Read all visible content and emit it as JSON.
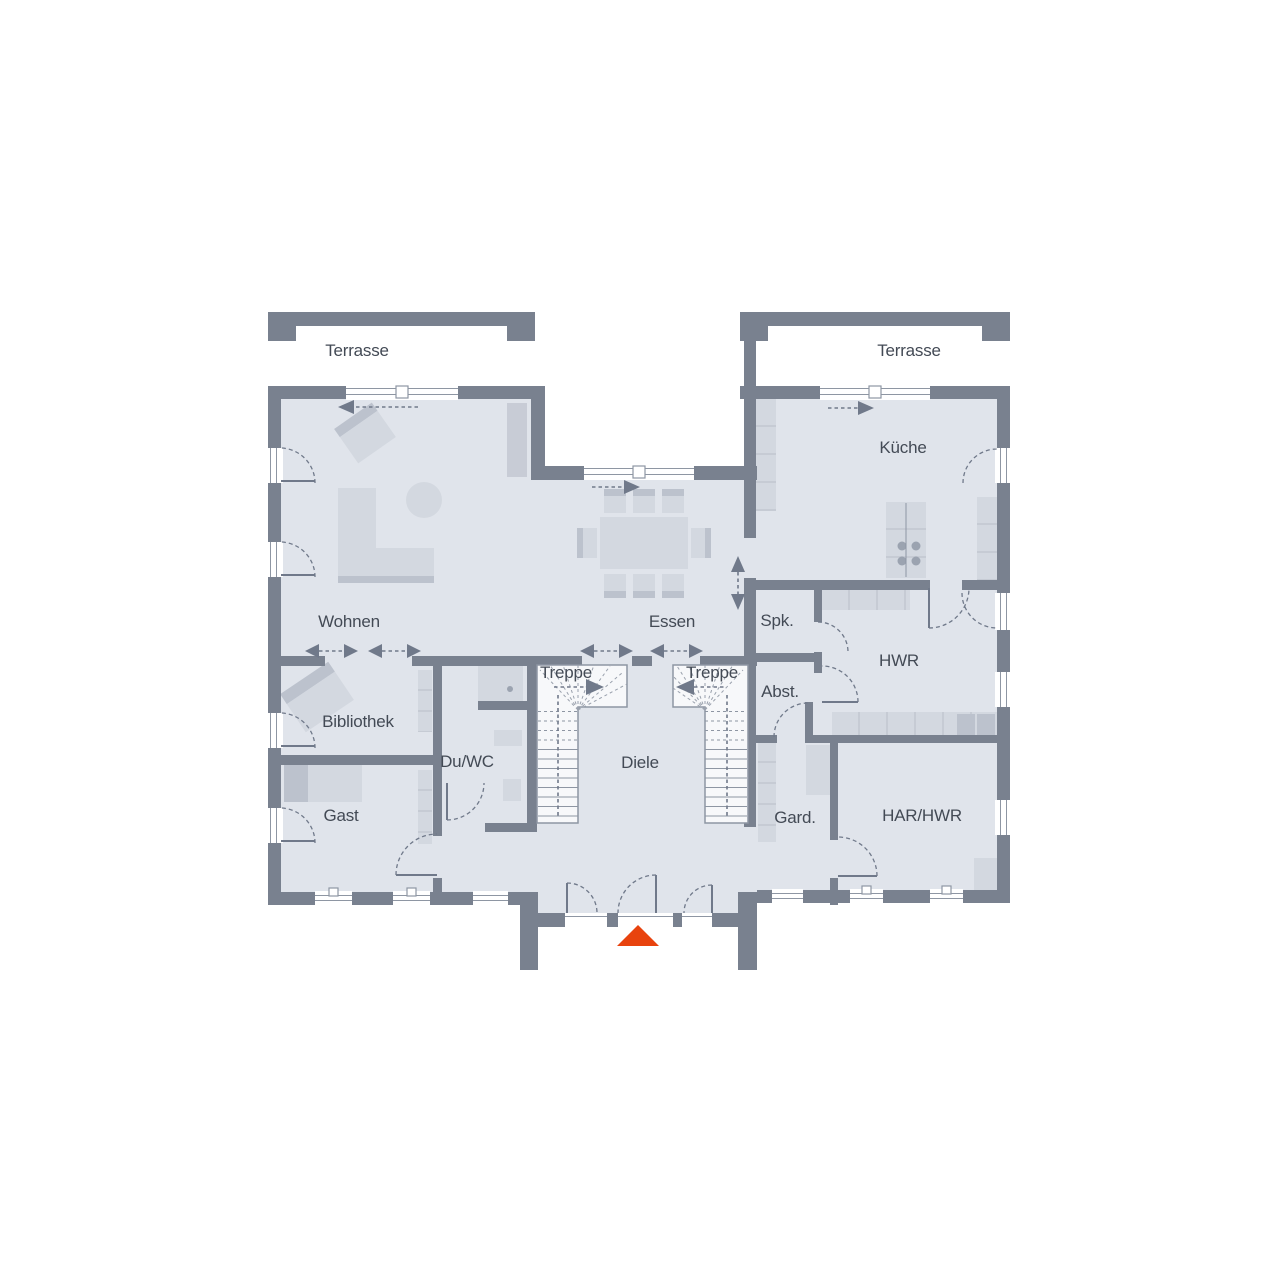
{
  "labels": {
    "terrasse_left": "Terrasse",
    "terrasse_right": "Terrasse",
    "wohnen": "Wohnen",
    "essen": "Essen",
    "kueche": "Küche",
    "spk": "Spk.",
    "hwr": "HWR",
    "abst": "Abst.",
    "treppe_left": "Treppe",
    "treppe_right": "Treppe",
    "bibliothek": "Bibliothek",
    "duwc": "Du/WC",
    "diele": "Diele",
    "gast": "Gast",
    "gard": "Gard.",
    "har_hwr": "HAR/HWR"
  },
  "colors": {
    "wall": "#79818f",
    "floor": "#e0e4eb",
    "white": "#ffffff",
    "furniture": "#d3d8e0",
    "furniture_dark": "#bcc2cd",
    "counter_line": "#c6cbd4",
    "stair_line": "#8e96a3",
    "annotation": "#70798a",
    "text": "#434a55",
    "entrance_accent": "#e8430e"
  }
}
